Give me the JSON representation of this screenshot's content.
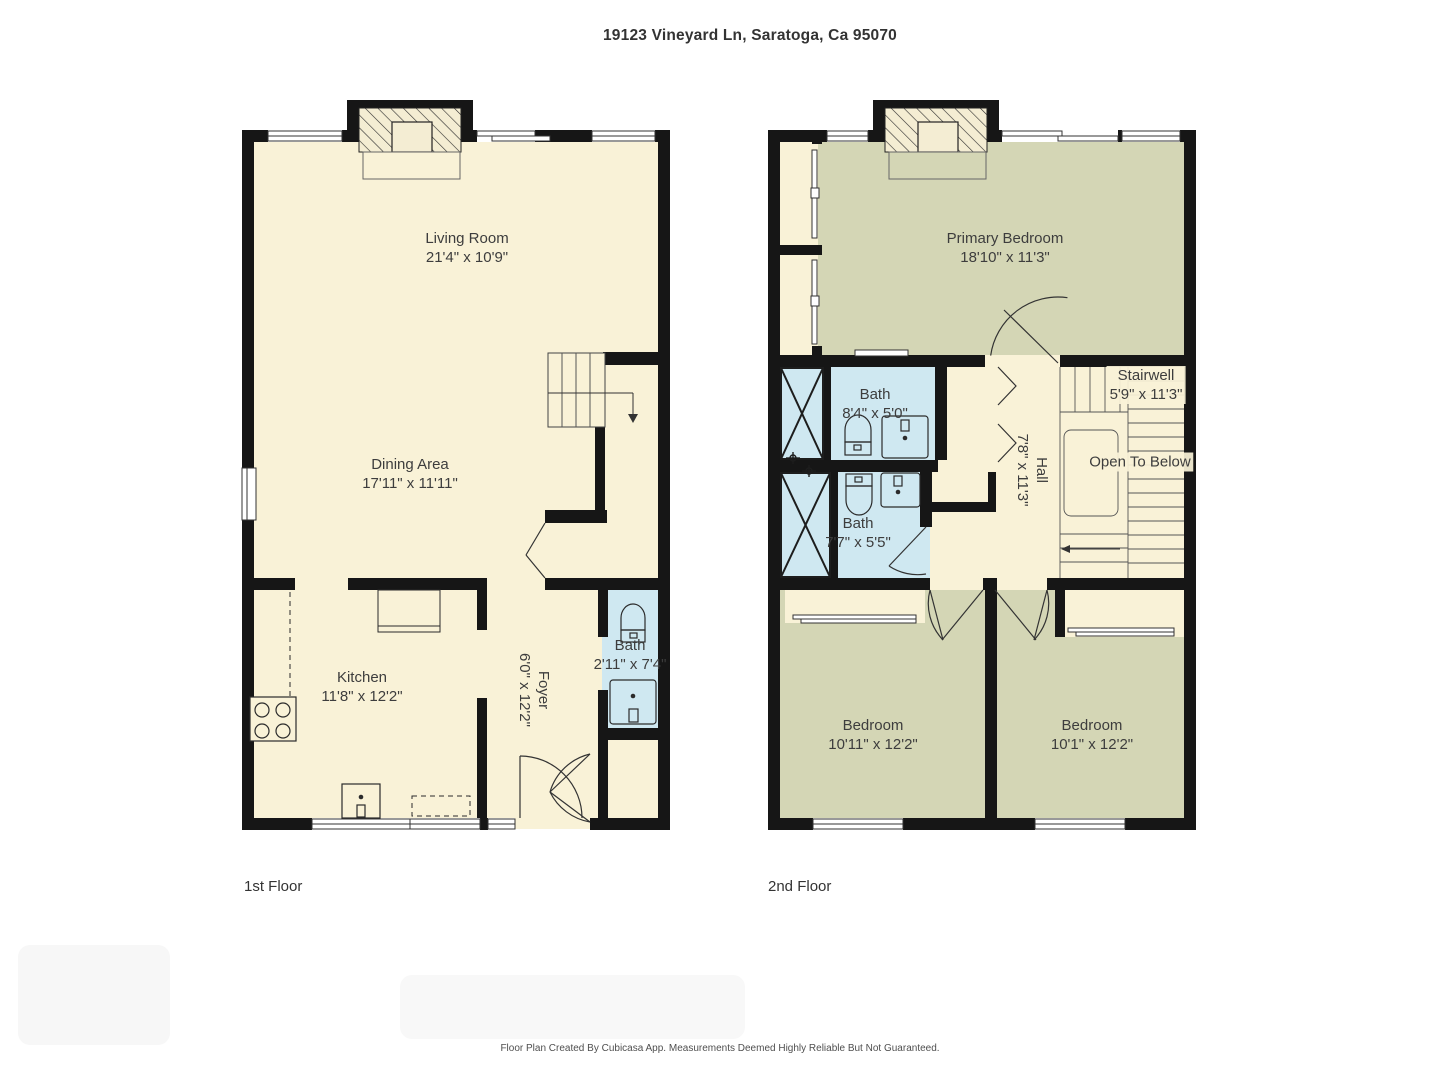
{
  "title": "19123 Vineyard Ln, Saratoga, Ca 95070",
  "floor1": {
    "caption": "1st Floor",
    "rooms": {
      "living": {
        "label": "Living Room",
        "dims": "21'4\" x 10'9\""
      },
      "dining": {
        "label": "Dining Area",
        "dims": "17'11\" x 11'11\""
      },
      "kitchen": {
        "label": "Kitchen",
        "dims": "11'8\" x 12'2\""
      },
      "foyer": {
        "label": "Foyer",
        "dims": "6'0\" x 12'2\""
      },
      "bath": {
        "label": "Bath",
        "dims": "2'11\" x 7'4\""
      }
    }
  },
  "floor2": {
    "caption": "2nd Floor",
    "rooms": {
      "primary": {
        "label": "Primary Bedroom",
        "dims": "18'10\" x 11'3\""
      },
      "bath_upper": {
        "label": "Bath",
        "dims": "8'4\" x 5'0\""
      },
      "bath_lower": {
        "label": "Bath",
        "dims": "7'7\" x 5'5\""
      },
      "hall": {
        "label": "Hall",
        "dims": "7'8\" x 11'3\""
      },
      "stairwell": {
        "label": "Stairwell",
        "dims": "5'9\" x 11'3\""
      },
      "open_below": {
        "label": "Open To Below"
      },
      "bedroom_a": {
        "label": "Bedroom",
        "dims": "10'11\" x 12'2\""
      },
      "bedroom_b": {
        "label": "Bedroom",
        "dims": "10'1\" x 12'2\""
      }
    }
  },
  "footer": {
    "disclaimer": "Floor Plan Created By Cubicasa App. Measurements Deemed Highly Reliable But Not Guaranteed."
  },
  "colors": {
    "floor_cream": "#f9f2d7",
    "room_olive": "#d4d6b5",
    "room_blue": "#cfe8f1",
    "wall": "#161616"
  }
}
